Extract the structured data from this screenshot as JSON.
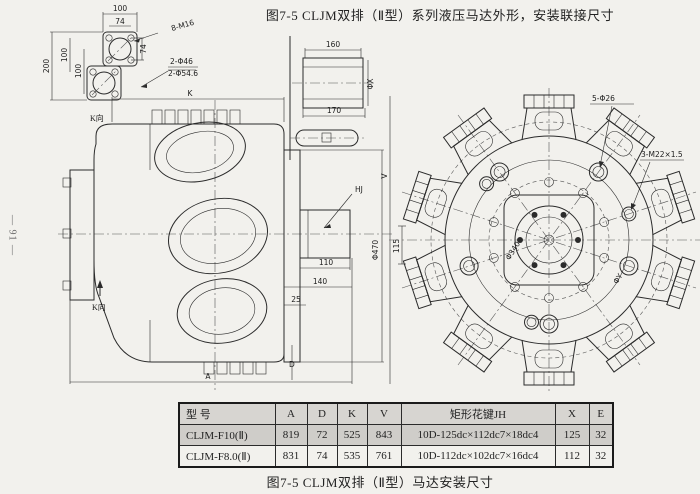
{
  "page": {
    "number": "— 91 —"
  },
  "figure": {
    "top_caption": "图7-5  CLJM双排（Ⅱ型）系列液压马达外形，安装联接尺寸",
    "bottom_caption": "图7-5  CLJM双排（Ⅱ型）马达安装尺寸"
  },
  "drawing": {
    "flange_detail": {
      "dim_width_outer": "100",
      "dim_width_bolts": "74",
      "bolt_note": "8-M16",
      "dim_height_outer": "200",
      "dim_height_bolts_1": "100",
      "dim_height_bolts_2": "100",
      "dim_side_bolts": "74",
      "hole_note_1": "2-Φ46",
      "hole_note_2": "2-Φ54.6",
      "view_label": "K向"
    },
    "shaft_detail": {
      "dim_length_inner": "160",
      "dim_length_outer": "170",
      "dim_diameter": "ΦX"
    },
    "main_view": {
      "dim_k": "K",
      "dim_a": "A",
      "dim_d": "D",
      "dim_v": "V",
      "dim_25": "25",
      "dim_110": "110",
      "dim_140": "140",
      "dim_115": "115",
      "dim_phi470": "Φ470",
      "shaft_label": "HJ",
      "view_label": "K向"
    },
    "circular_view": {
      "hole_note_phi26": "5-Φ26",
      "thread_note_m22": "3-M22×1.5",
      "dim_phi340": "Φ340",
      "dim_phiY": "ΦY"
    }
  },
  "table": {
    "headers": [
      "型 号",
      "A",
      "D",
      "K",
      "V",
      "矩形花键JH",
      "X",
      "E"
    ],
    "rows": [
      [
        "CLJM-F10(Ⅱ)",
        "819",
        "72",
        "525",
        "843",
        "10D-125dc×112dc7×18dc4",
        "125",
        "32"
      ],
      [
        "CLJM-F8.0(Ⅱ)",
        "831",
        "74",
        "535",
        "761",
        "10D-112dc×102dc7×16dc4",
        "112",
        "32"
      ]
    ]
  },
  "colors": {
    "paper": "#f2f1ed",
    "ink": "#2b2b2b",
    "table_header_bg": "#d7d5d1",
    "table_row_shaded_bg": "#cfcdc9"
  }
}
